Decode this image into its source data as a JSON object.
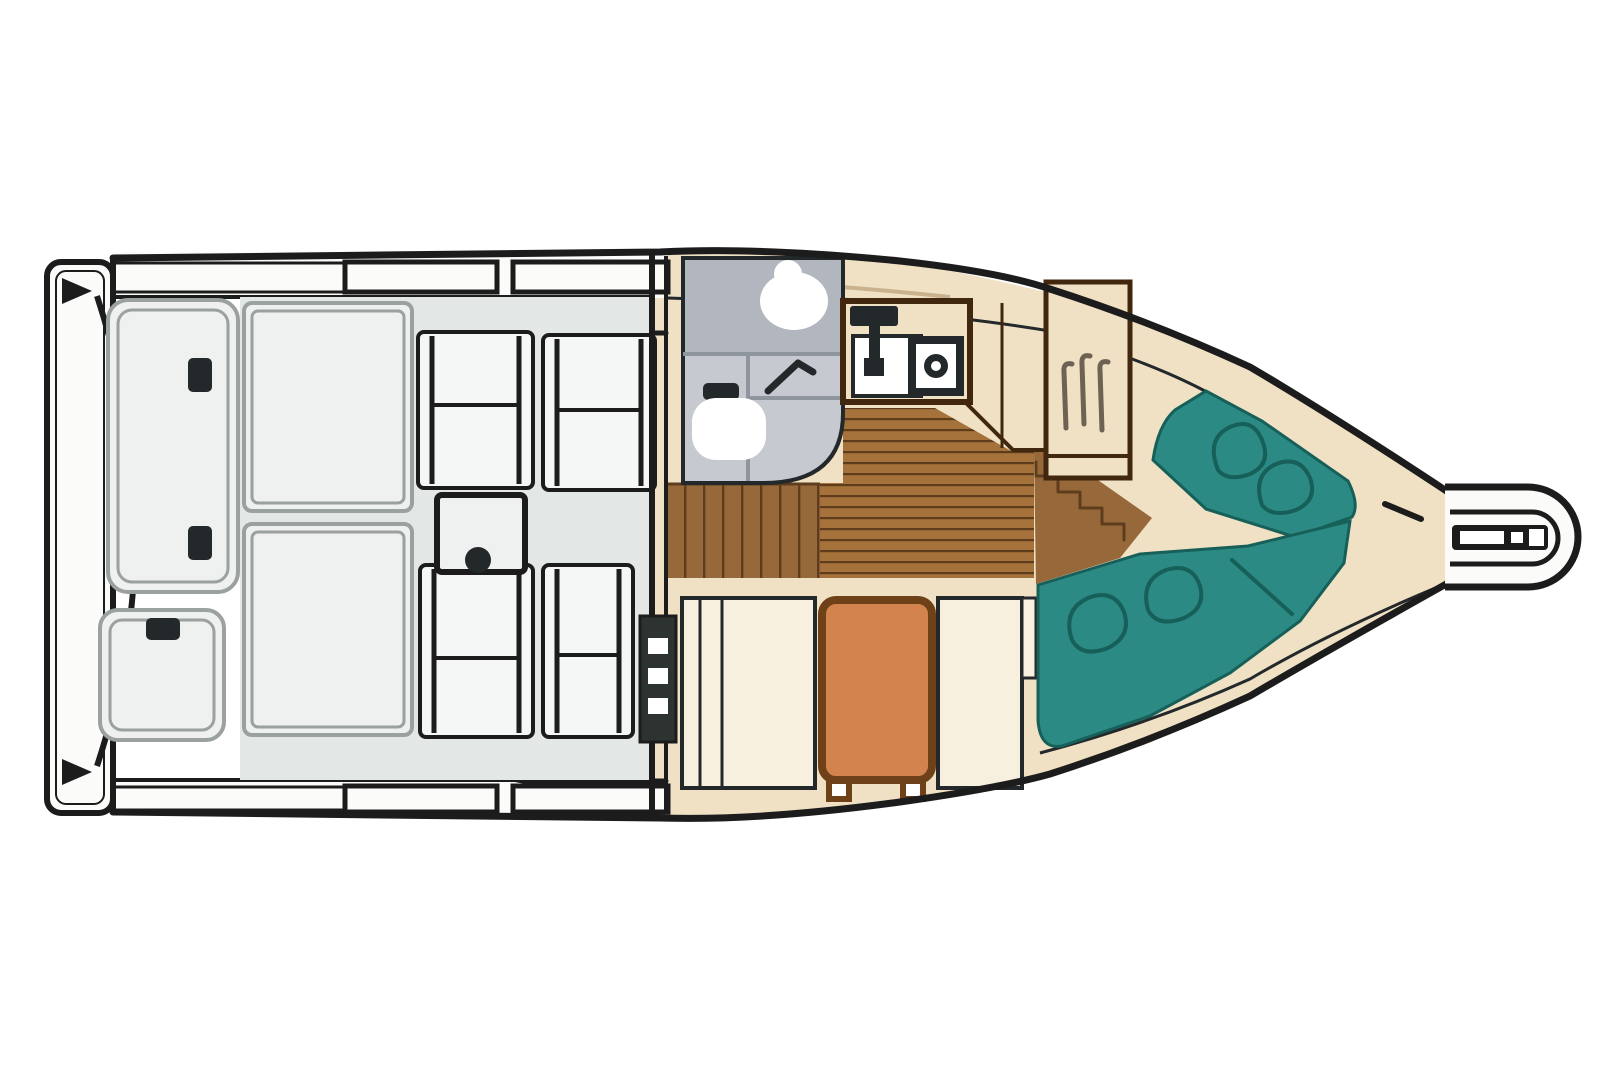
{
  "palette": {
    "background": "#ffffff",
    "ink": "#1c1c1c",
    "ink_soft": "#23282a",
    "deck_white": "#fbfbfa",
    "cockpit_floor": "#e3e8e7",
    "hatch_fill": "#eef1f0",
    "hatch_border": "#9aa19f",
    "seat_fill": "#f5f7f6",
    "head_upper": "#b2b7bf",
    "head_lower": "#c6cad0",
    "head_divider": "#8f959d",
    "fixture_white": "#ffffff",
    "cabin_cream": "#f0e1c5",
    "cream_light": "#f8f0de",
    "trim_tan": "#c9b28d",
    "wood": "#a5723c",
    "wood_steps": "#96683a",
    "wood_dark": "#5e3d1d",
    "furniture_outline": "#40270e",
    "table_orange": "#d2834e",
    "table_border": "#6f4119",
    "cushion_teal": "#2b8a84",
    "cushion_line": "#176059",
    "door_dark": "#2d3330",
    "hanger": "#6e6253"
  },
  "diagram": {
    "type": "boat-floor-plan",
    "orientation": "bow-right-stern-left",
    "components": [
      {
        "id": "swim-platform",
        "label": "swim platform with cleats"
      },
      {
        "id": "transom",
        "label": "curved transom"
      },
      {
        "id": "engine-hatch-aft",
        "label": "aft engine hatch with latches"
      },
      {
        "id": "engine-hatch-small",
        "label": "small stern hatch"
      },
      {
        "id": "cockpit",
        "label": "cockpit with sole"
      },
      {
        "id": "cockpit-lockers",
        "label": "port-side storage lockers"
      },
      {
        "id": "cockpit-seats",
        "label": "four cockpit seats"
      },
      {
        "id": "cockpit-table",
        "label": "cockpit pedestal table"
      },
      {
        "id": "side-decks",
        "label": "port and starboard side decks"
      },
      {
        "id": "companionway-door",
        "label": "cabin entry door"
      },
      {
        "id": "head",
        "label": "head compartment with toilet, sink, shower"
      },
      {
        "id": "galley",
        "label": "galley with sink, faucet and stove"
      },
      {
        "id": "cabin-sole",
        "label": "teak cabin sole planks"
      },
      {
        "id": "cabin-steps",
        "label": "companionway steps"
      },
      {
        "id": "berth-steps",
        "label": "steps up to v-berth"
      },
      {
        "id": "dinette",
        "label": "dinette with orange table and two benches"
      },
      {
        "id": "hanging-locker",
        "label": "hanging locker with hangers"
      },
      {
        "id": "v-berth",
        "label": "teal v-berth cushions with pillows"
      },
      {
        "id": "bow-pulpit",
        "label": "bow pulpit"
      },
      {
        "id": "anchor-roller",
        "label": "anchor roller"
      },
      {
        "id": "bow-light",
        "label": "bow navigation light mark"
      }
    ]
  }
}
